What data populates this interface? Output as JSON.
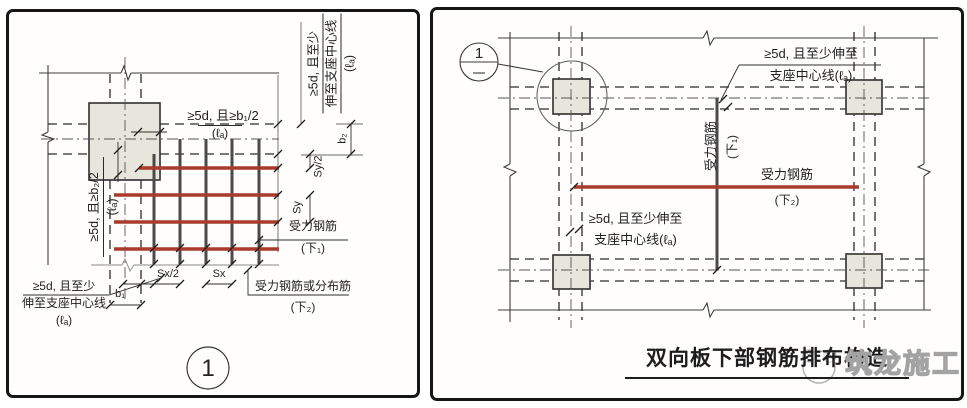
{
  "panel_left": {
    "anno_top": "≥5d, 且≥b₁/2",
    "anno_top_la": "(ℓₐ)",
    "anno_left_l1": "≥5d, 且≥b₂/2",
    "anno_left_la": "(ℓₐ)",
    "anno_right_l1": "≥5d, 且至少",
    "anno_right_l2": "伸至支座中心线",
    "anno_right_la": "(ℓₐ)",
    "anno_bottom_l1": "≥5d, 且至少",
    "anno_bottom_l2": "伸至支座中心线",
    "anno_bottom_la": "(ℓₐ)",
    "dims": {
      "b1": "b₁",
      "b2": "b₂",
      "sx": "Sx",
      "sx_half": "Sx/2",
      "sy": "Sy",
      "sy_half": "Sy/2"
    },
    "rebar_main_label": "受力钢筋",
    "rebar_main_sub": "(下₁)",
    "rebar_dist_label": "受力钢筋或分布筋",
    "rebar_dist_sub": "(下₂)",
    "detail_number": "1"
  },
  "panel_right": {
    "bubble_number": "1",
    "anno_top_l1": "≥5d, 且至少伸至",
    "anno_top_l2": "支座中心线(ℓₐ)",
    "anno_mid_l1": "≥5d, 且至少伸至",
    "anno_mid_l2": "支座中心线(ℓₐ)",
    "vbar_label": "受力钢筋",
    "vbar_sub": "(下₁)",
    "hbar_label": "受力钢筋",
    "hbar_sub": "(下₂)",
    "title": "双向板下部钢筋排布构造",
    "watermark": "筑龙施工"
  },
  "colors": {
    "rebar_red": "#a93a2c",
    "rebar_dark": "#4a4a4a",
    "column_fill": "#e7e6dc",
    "line": "#2e2e2e"
  }
}
